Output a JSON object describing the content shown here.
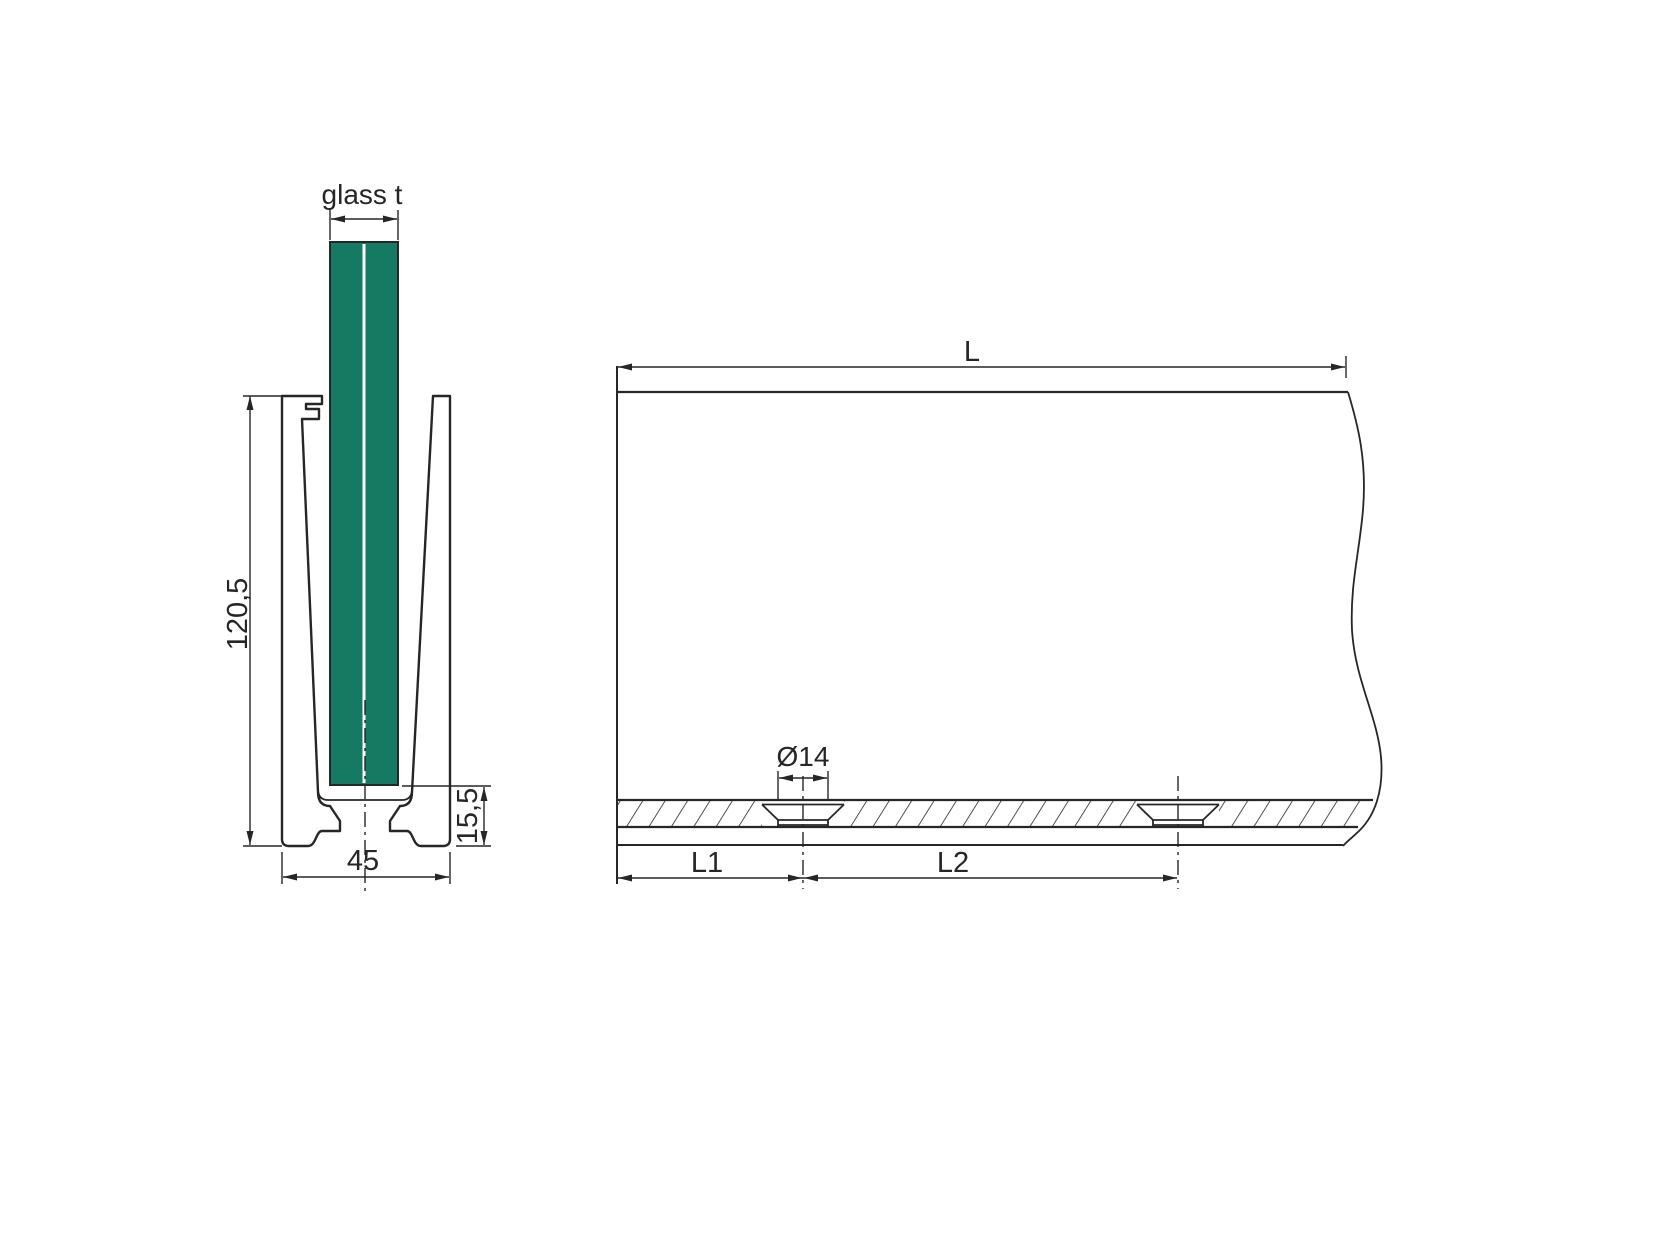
{
  "drawing": {
    "cross_section_view": {
      "labels": {
        "glass_thickness": "glass t",
        "profile_height": "120,5",
        "base_height": "15,5",
        "profile_width": "45"
      }
    },
    "elevation_view": {
      "labels": {
        "total_length": "L",
        "hole_diameter": "Ø14",
        "first_hole_offset": "L1",
        "hole_spacing": "L2"
      }
    },
    "colors": {
      "glass_green": "#157a61",
      "line": "#262626",
      "background": "#ffffff"
    }
  }
}
